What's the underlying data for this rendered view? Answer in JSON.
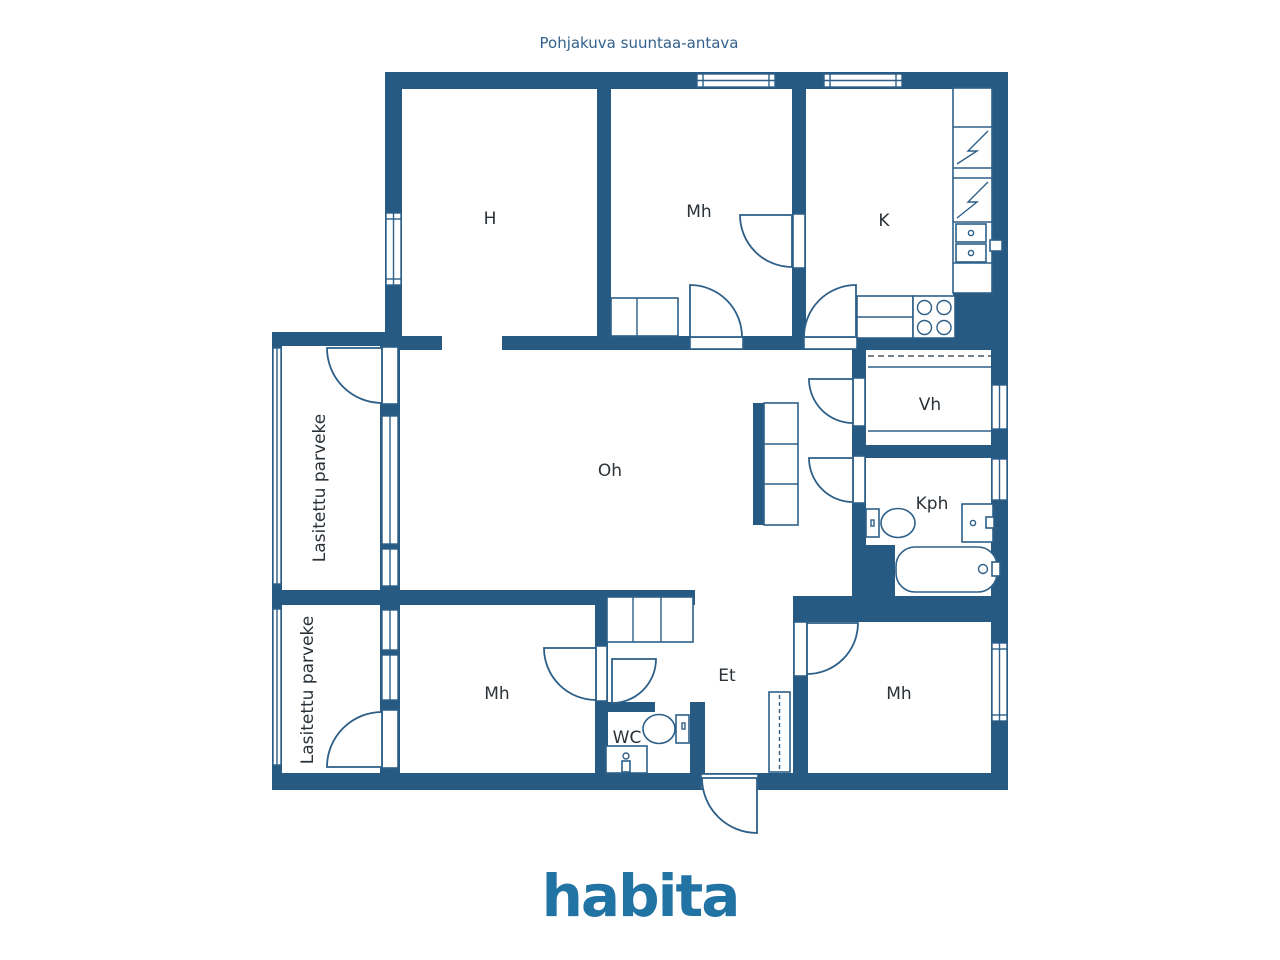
{
  "title": "Pohjakuva suuntaa-antava",
  "logo": "habita",
  "colors": {
    "wall": "#275a83",
    "line": "#2d5f88",
    "label": "#2a3238",
    "title_text": "#33618c",
    "logo_blue": "#2173a3"
  },
  "rooms": [
    {
      "id": "h",
      "label": "H"
    },
    {
      "id": "mh-top",
      "label": "Mh"
    },
    {
      "id": "k",
      "label": "K"
    },
    {
      "id": "oh",
      "label": "Oh"
    },
    {
      "id": "vh",
      "label": "Vh"
    },
    {
      "id": "kph",
      "label": "Kph"
    },
    {
      "id": "et",
      "label": "Et"
    },
    {
      "id": "mh-bottom-left",
      "label": "Mh"
    },
    {
      "id": "mh-bottom-right",
      "label": "Mh"
    },
    {
      "id": "wc",
      "label": "WC"
    }
  ],
  "balconies": [
    {
      "id": "balcony-upper",
      "label": "Lasitettu parveke"
    },
    {
      "id": "balcony-lower",
      "label": "Lasitettu parveke"
    }
  ]
}
